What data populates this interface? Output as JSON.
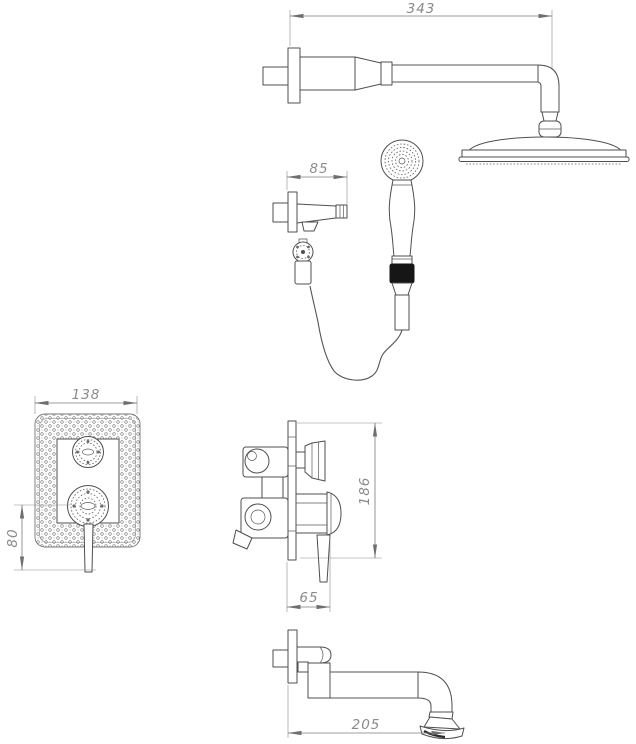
{
  "dimensions": {
    "shower_arm_length": "343",
    "holder_projection": "85",
    "plate_width": "138",
    "handle_offset": "80",
    "plate_height": "186",
    "valve_projection": "65",
    "spout_length": "205"
  },
  "colors": {
    "background": "#ffffff",
    "line": "#4f4f4f",
    "dimension": "#8a8a8a",
    "grip_band": "#161616"
  }
}
